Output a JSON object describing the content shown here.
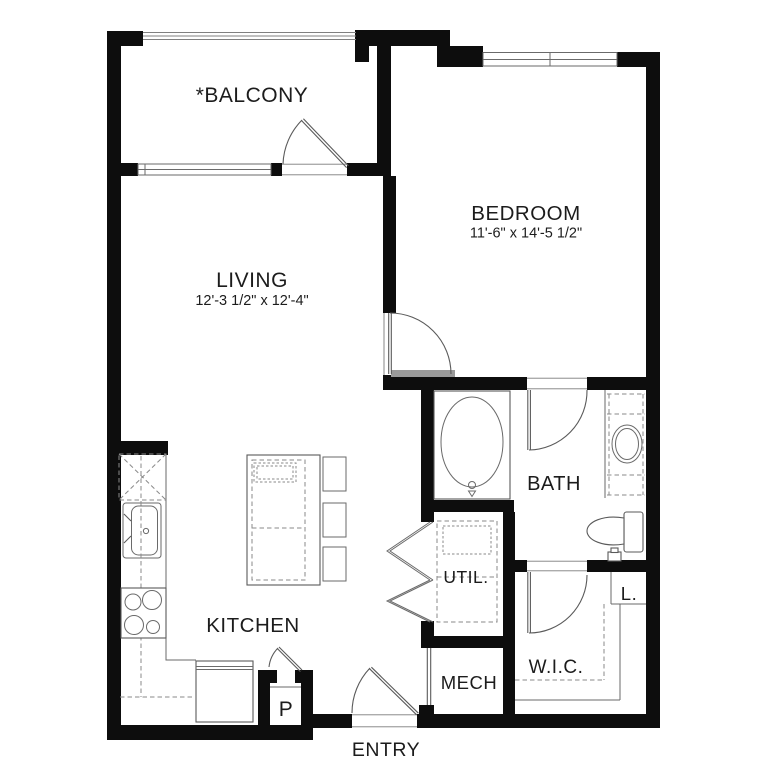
{
  "floorplan": {
    "rooms": {
      "balcony": {
        "label": "*BALCONY"
      },
      "living": {
        "label": "LIVING",
        "dimensions": "12'-3 1/2\" x 12'-4\""
      },
      "bedroom": {
        "label": "BEDROOM",
        "dimensions": "11'-6\" x 14'-5 1/2\""
      },
      "bath": {
        "label": "BATH"
      },
      "utility": {
        "label": "UTIL."
      },
      "mechanical": {
        "label": "MECH"
      },
      "walk_in_closet": {
        "label": "W.I.C."
      },
      "linen_closet": {
        "label": "L."
      },
      "kitchen": {
        "label": "KITCHEN"
      },
      "pantry": {
        "label": "P"
      },
      "entry": {
        "label": "ENTRY"
      }
    },
    "colors": {
      "wall": "#0d0d0d",
      "line": "#5a5a5a",
      "dashed_line": "#8a8a8a",
      "text": "#1c1c1c",
      "background": "#ffffff"
    }
  }
}
